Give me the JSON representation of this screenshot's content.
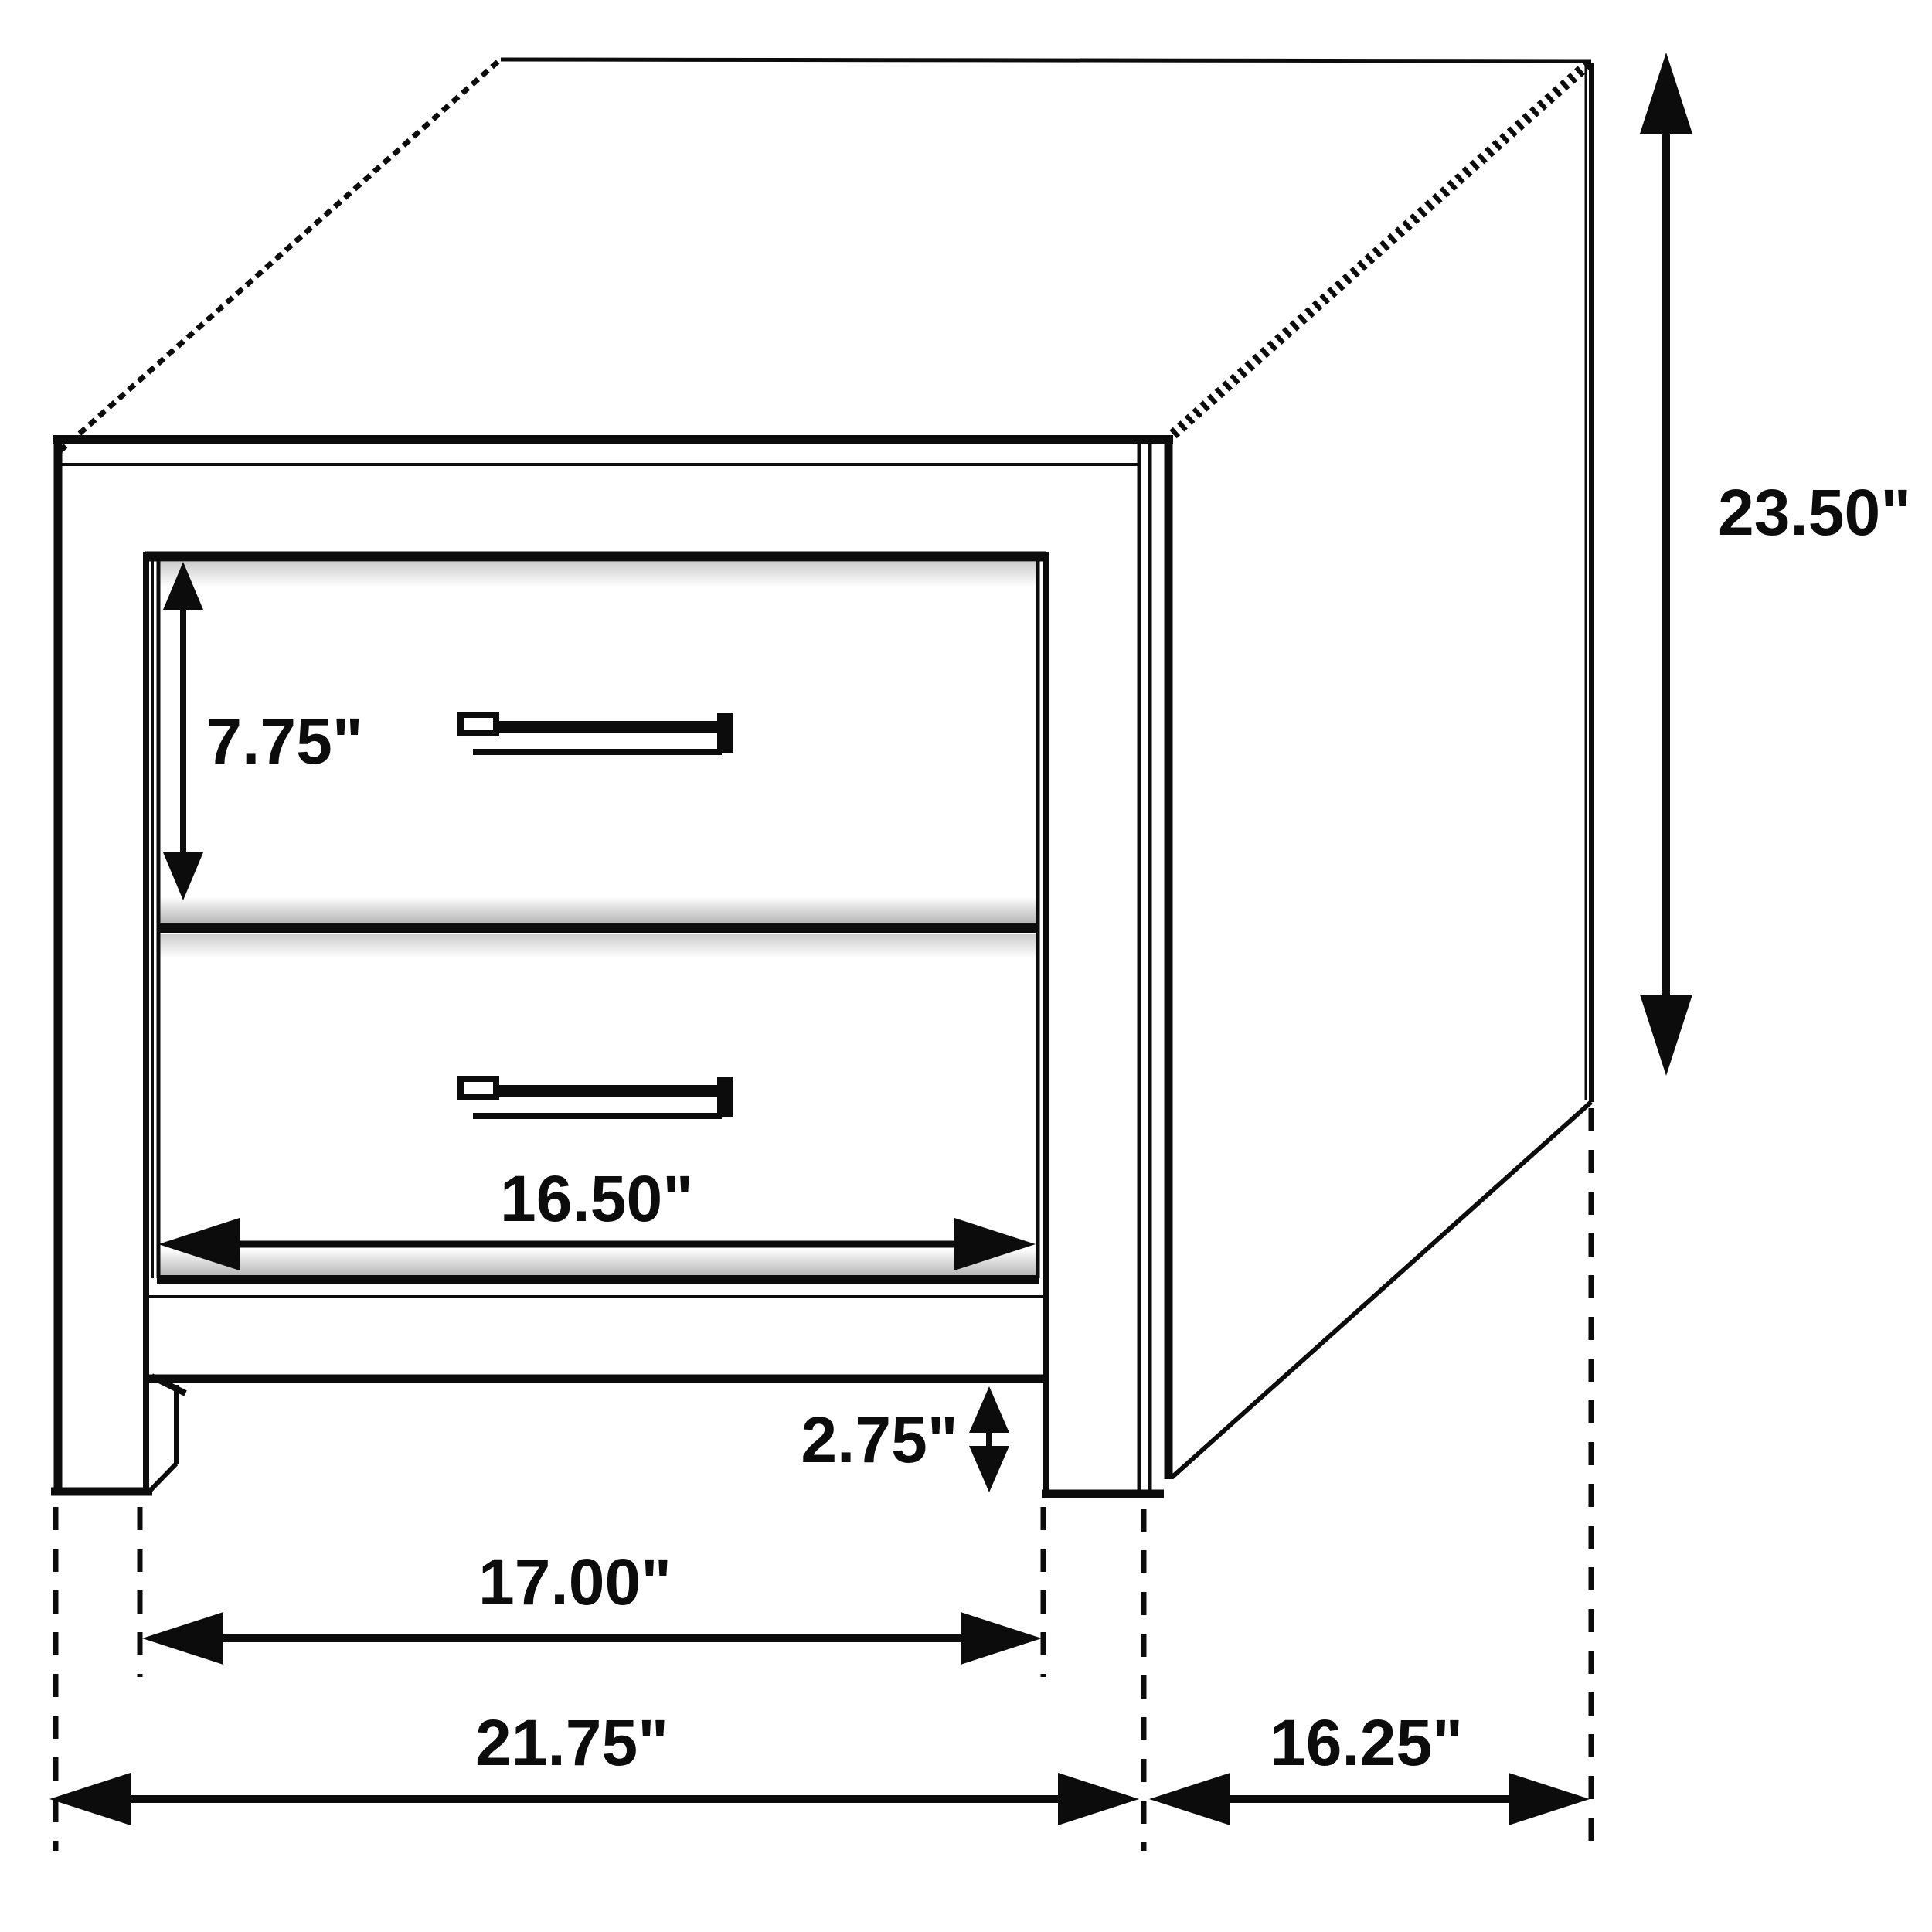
{
  "figure": {
    "kind": "furniture-dimension-line-drawing",
    "object": "two-drawer nightstand"
  },
  "dimensions": {
    "overall_height": {
      "value": "23.50\""
    },
    "overall_width": {
      "value": "21.75\""
    },
    "overall_depth": {
      "value": "16.25\""
    },
    "drawer_front_height": {
      "value": "7.75\""
    },
    "drawer_width": {
      "value": "16.50\""
    },
    "leg_clearance": {
      "value": "2.75\""
    },
    "between_legs_width": {
      "value": "17.00\""
    }
  },
  "colors": {
    "ink": "#0c0c0c",
    "paper": "#ffffff",
    "soft_shadow": "#a8a8a8"
  }
}
